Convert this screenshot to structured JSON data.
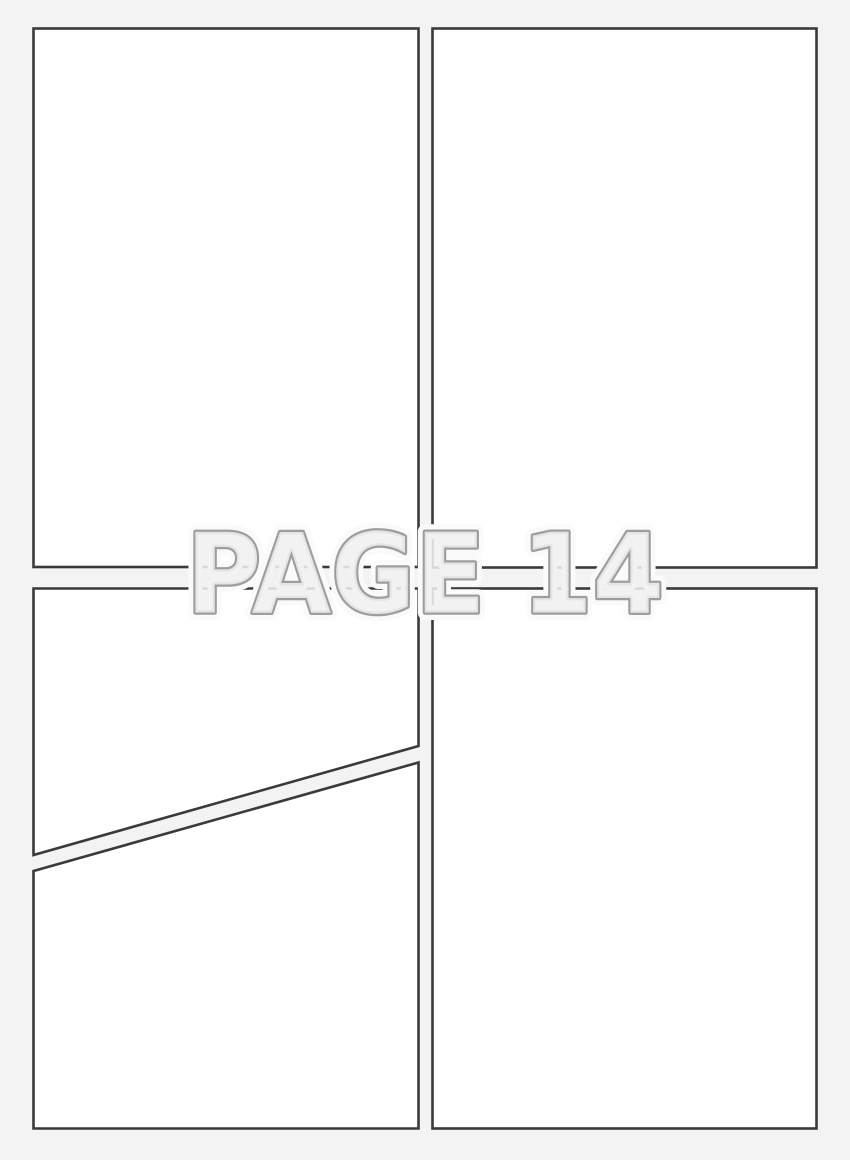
{
  "page": {
    "background_color": "#f3f3f3"
  },
  "panels": {
    "fill_color": "#ffffff",
    "border_color": "#3a3a3a"
  },
  "watermark": {
    "text": "PAGE 14",
    "fill_color": "#f0f0f0",
    "outline_color": "#9e9e9e",
    "halo_color": "#fafafa"
  }
}
